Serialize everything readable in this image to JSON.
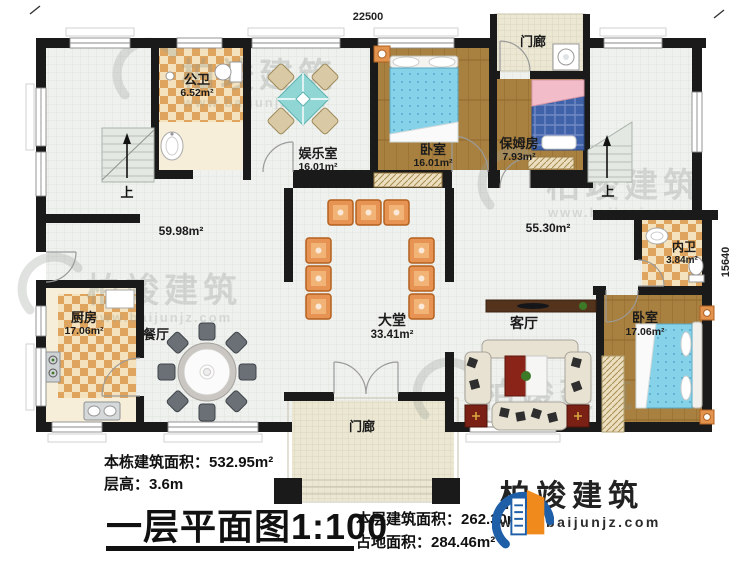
{
  "plan": {
    "dim_top": "22500",
    "dim_right": "15640",
    "rooms": {
      "gongwei": {
        "name": "公卫",
        "area": "6.52m²"
      },
      "yuleshi": {
        "name": "娱乐室",
        "area": "16.01m²"
      },
      "woshi_top": {
        "name": "卧室",
        "area": "16.01m²"
      },
      "menlang_top": {
        "name": "门廊"
      },
      "baomufang": {
        "name": "保姆房",
        "area": "7.93m²"
      },
      "neiwei": {
        "name": "内卫",
        "area": "3.84m²"
      },
      "woshi_right": {
        "name": "卧室",
        "area": "17.06m²"
      },
      "keting": {
        "name": "客厅"
      },
      "datang": {
        "name": "大堂",
        "area": "33.41m²"
      },
      "canting": {
        "name": "餐厅"
      },
      "chufang": {
        "name": "厨房",
        "area": "17.06m²"
      },
      "menlang_bottom": {
        "name": "门廊"
      }
    },
    "open_areas": {
      "left": "59.98m²",
      "right": "55.30m²"
    },
    "stairs": {
      "up_left": "上",
      "up_right": "上"
    }
  },
  "annotations": {
    "building_total_label": "本栋建筑面积：",
    "building_total_value": "532.95m²",
    "floor_height_label": "层高：",
    "floor_height_value": "3.6m",
    "title": "一层平面图",
    "scale": "1:100",
    "floor_area_label": "本层建筑面积：",
    "floor_area_value": "262.30m²",
    "footprint_label": "占地面积：",
    "footprint_value": "284.46m²"
  },
  "branding": {
    "company": "柏竣建筑",
    "website": "www.baijunjz.com"
  },
  "watermark": {
    "text": "柏竣建筑",
    "url": "www.baijunjz.com"
  },
  "colors": {
    "wall": "#1a1a1a",
    "accent_blue": "#1f5fa8",
    "accent_orange": "#f08a1d",
    "bed_blue": "#86d2e8",
    "chair_orange": "#e79353",
    "checker_tan": "#dfa55e",
    "wood": "#a8803f"
  }
}
